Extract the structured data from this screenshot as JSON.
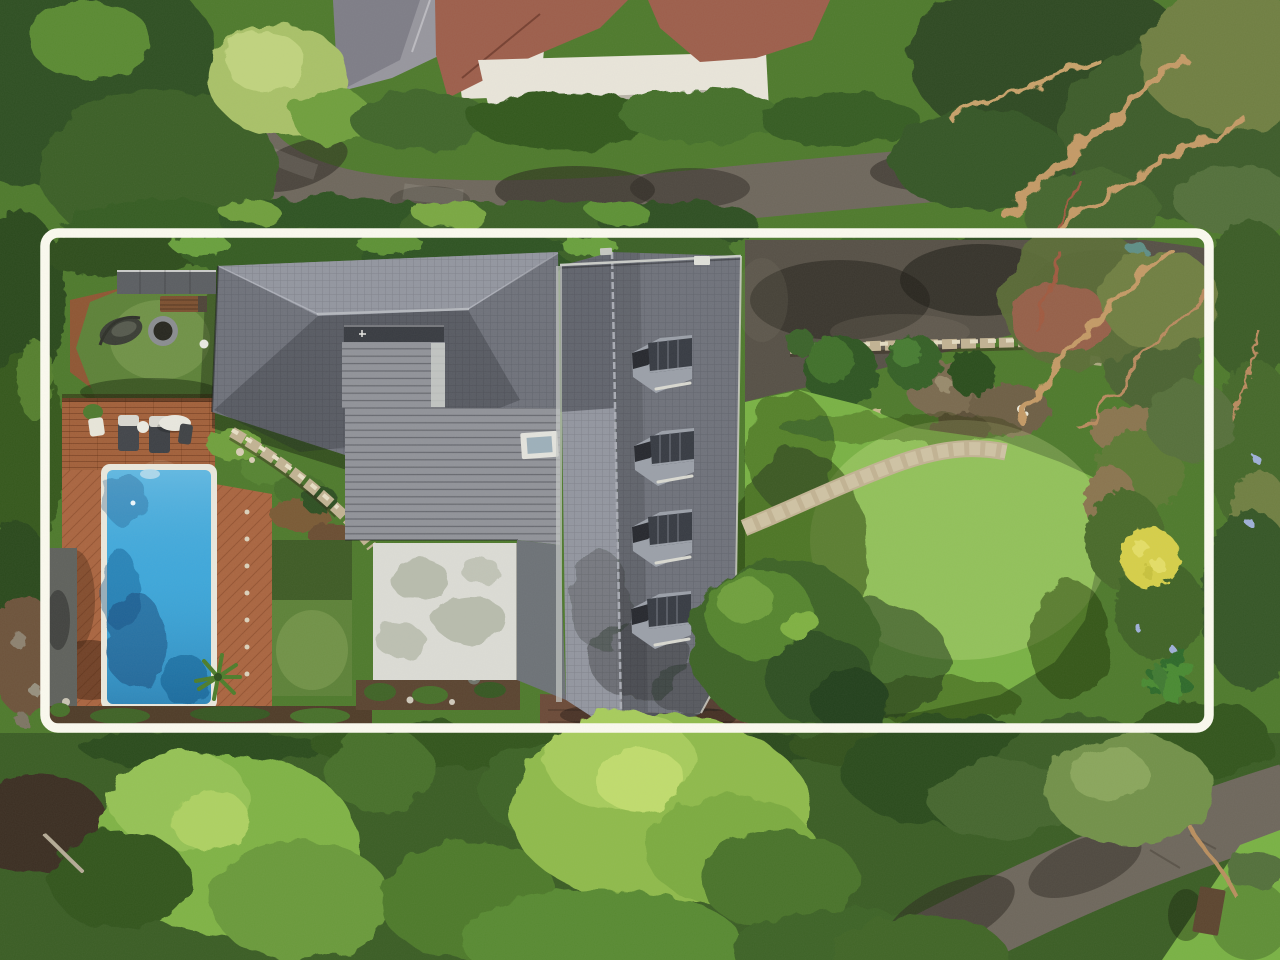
{
  "image": {
    "type": "aerial-drone-photograph",
    "subject": "residential property with marked lot boundary",
    "view": "top-down",
    "width_px": 1280,
    "height_px": 960
  },
  "overlay": {
    "name": "property-boundary",
    "shape": "rounded-rectangle",
    "color": "#fbfaef",
    "x": 45,
    "y": 233,
    "width": 1164,
    "height": 495,
    "stroke_px": 9.5,
    "corner_radius": 13
  },
  "palette": {
    "foliage_dark": "#33541f",
    "foliage_mid": "#4e7a2c",
    "foliage_bright": "#7cb041",
    "foliage_yellow": "#a8c45c",
    "lawn": "#79b244",
    "turf": "#5d8238",
    "road": "#6e675c",
    "driveway": "#565046",
    "roof_slate_light": "#9396a0",
    "roof_slate_mid": "#6f727b",
    "roof_slate_dark": "#4d5057",
    "roof_metal": "#919399",
    "roof_white": "#dcdcd5",
    "deck_timber": "#a2603a",
    "deck_pavers": "#aa6540",
    "pool_water": "#3fa9dc",
    "pool_coping": "#eae8dd",
    "stone": "#c2b393",
    "brick_wall": "#6b4a38",
    "neighbor_brick": "#9d5e4b",
    "neighbor_wall": "#e9e5da",
    "neighbor_slate": "#97969e",
    "branch": "#c49a66"
  },
  "scene": {
    "house": {
      "dormer_windows": 4,
      "skylights": 1,
      "chimneys": 1,
      "roof_sections": [
        "hipped-slate",
        "standing-seam-metal",
        "white-flat-roof",
        "gabled-slate"
      ]
    },
    "pool": {
      "shape": "rectangle",
      "count": 1
    },
    "furniture": {
      "sun_loungers": 2,
      "outdoor_tables": 1,
      "fire_pits": 1,
      "hanging_chairs": 1
    },
    "landscape": [
      "street-top",
      "street-bottom",
      "driveway",
      "backyard-lawn",
      "stone-path",
      "stone-retaining-wall",
      "artificial-turf",
      "timber-deck",
      "garden-beds",
      "hedges",
      "tree-canopy",
      "yellow-flower-patch"
    ]
  }
}
